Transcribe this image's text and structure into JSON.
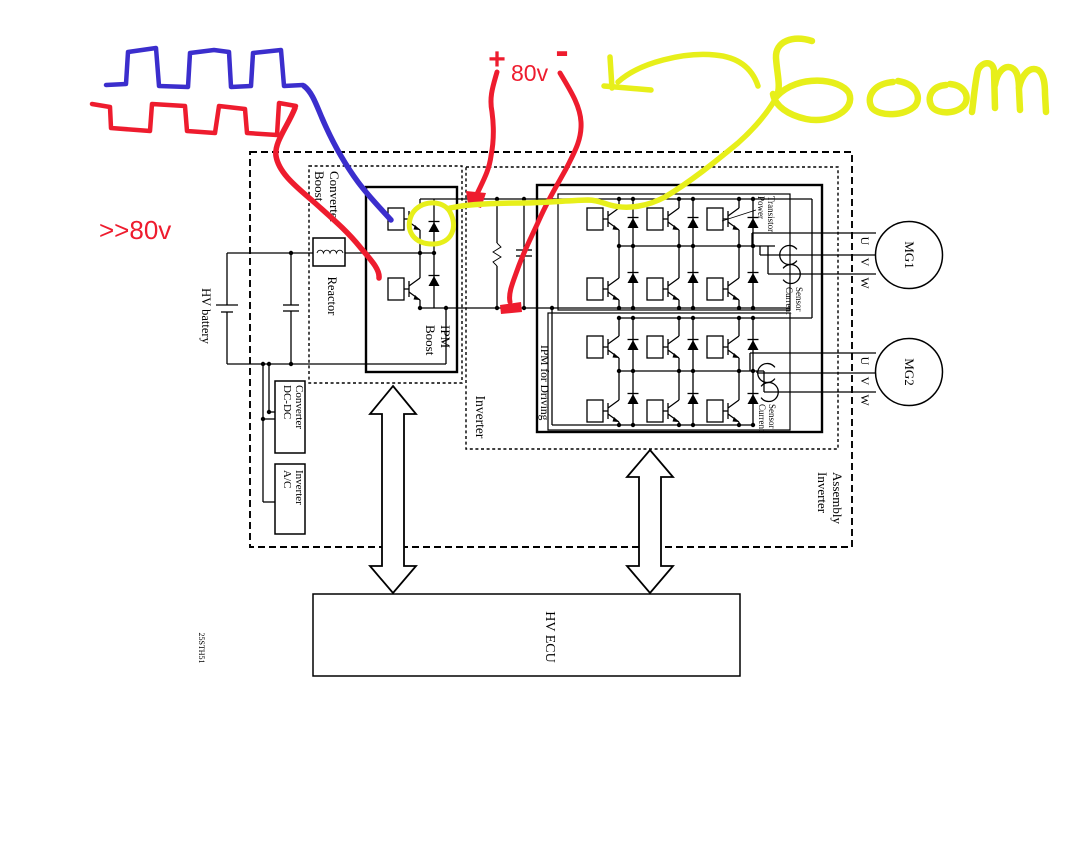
{
  "colors": {
    "annotation_red": "#ee1c2e",
    "annotation_blue": "#3b2ecd",
    "annotation_yellow": "#e7ef1a",
    "diagram_line": "#000000",
    "background": "#ffffff"
  },
  "annotations": {
    "red": {
      "wave_note": ">>80v",
      "bus_plus": "+",
      "bus_voltage": "80v",
      "bus_minus": "-"
    },
    "yellow": {
      "boom": "Boom"
    }
  },
  "diagram": {
    "assembly": {
      "label_line1": "Inverter",
      "label_line2": "Assembly"
    },
    "boost": {
      "label_line1": "Boost",
      "label_line2": "Converter",
      "reactor": "Reactor",
      "ipm_line1": "Boost",
      "ipm_line2": "IPM"
    },
    "battery": {
      "label": "HV battery"
    },
    "dcdc": {
      "line1": "DC-DC",
      "line2": "Converter"
    },
    "ac": {
      "line1": "A/C",
      "line2": "Inverter"
    },
    "inverter": {
      "label": "Inverter",
      "ipm": "IPM for Driving",
      "power_line1": "Power",
      "power_line2": "Transistor",
      "sensor_line1": "Current",
      "sensor_line2": "Sensor"
    },
    "motors": {
      "mg1": "MG1",
      "mg2": "MG2",
      "phases": [
        "U",
        "V",
        "W"
      ]
    },
    "ecu": {
      "label": "HV ECU"
    },
    "doc_number": "25STH51"
  }
}
